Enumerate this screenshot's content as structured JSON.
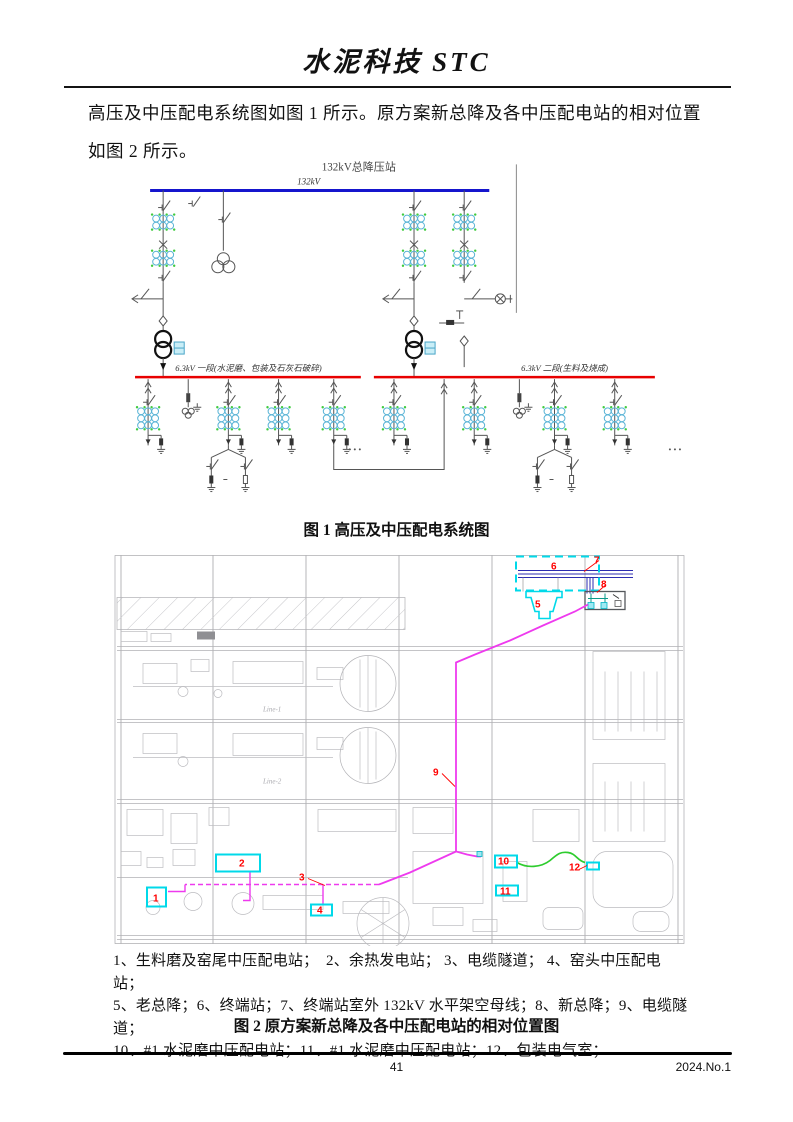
{
  "page": {
    "journal_title": "水泥科技 STC",
    "body_text_line1": "高压及中压配电系统图如图 1 所示。原方案新总降及各中压配电站的相对位置",
    "body_text_line2": "如图 2 所示。",
    "footer": {
      "page_number": "41",
      "issue_number": "2024.No.1"
    }
  },
  "figure1": {
    "station_title": "132kV总降压站",
    "hv_bus_label": "132kV",
    "mv_bus1_label": "6.3kV 一段(水泥磨、包装及石灰石破碎)",
    "mv_bus2_label": "6.3kV 二段(生料及烧成)",
    "caption": "图 1 高压及中压配电系统图",
    "colors": {
      "hv_bus": "#1515cd",
      "mv_bus": "#e80000",
      "ct_ring": "#5ab4d6",
      "ct_dot": "#3fca3f"
    }
  },
  "figure2": {
    "caption": "图 2 原方案新总降及各中压配电站的相对位置图",
    "plan_labels": {
      "line1": "Line-1",
      "line2": "Line-2"
    },
    "markers": [
      "1",
      "2",
      "3",
      "4",
      "5",
      "6",
      "7",
      "8",
      "9",
      "10",
      "11",
      "12"
    ],
    "legend_lines": [
      "1、生料磨及窑尾中压配电站；　2、余热发电站； 3、电缆隧道； 4、窑头中压配电站；",
      "5、老总降；6、终端站；7、终端站室外 132kV 水平架空母线；8、新总降；9、电缆隧道；",
      "10、#1 水泥磨中压配电站；11、#1 水泥磨中压配电站；12、包装电气室；"
    ],
    "colors": {
      "highlight": "#00d9e9",
      "cable_route": "#ee3aee",
      "marker_label": "#ff0000",
      "green_route": "#2ecc2e",
      "overhead_bus": "#2b2bb0"
    }
  }
}
